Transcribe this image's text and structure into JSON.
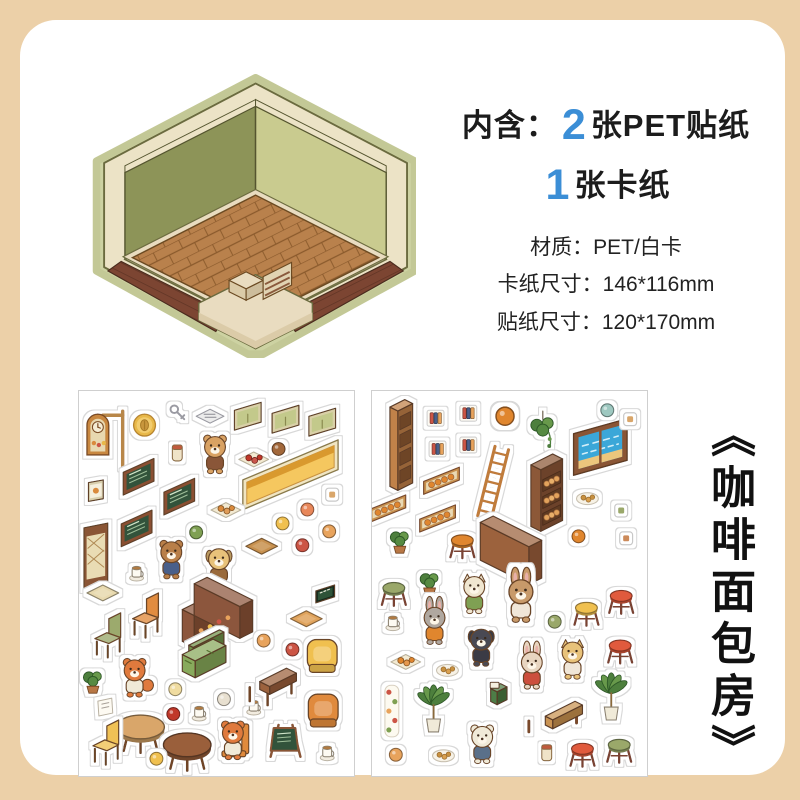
{
  "page": {
    "background": "#ecd0a8",
    "card_background": "#ffffff"
  },
  "header": {
    "prefix": "内含：",
    "count_stickers": "2",
    "stickers_label": "张PET贴纸",
    "count_card": "1",
    "card_label": "张卡纸",
    "accent_color": "#3b8ed6"
  },
  "specs": {
    "material": "材质：PET/白卡",
    "card_size": "卡纸尺寸：146*116mm",
    "sticker_size": "贴纸尺寸：120*170mm"
  },
  "product_title": "《咖啡面包房》",
  "room_preview": {
    "wall_left_color": "#8d9458",
    "wall_right_color": "#c9cb8f",
    "floor_color": "#b9814c",
    "deck_color": "#7c4532",
    "platform_color": "#e9dcc0",
    "trim_color": "#ece3c6"
  },
  "sheets": [
    {
      "name": "sticker-sheet-1",
      "theme": "coffee-shop",
      "stickers": [
        {
          "t": "clocksign",
          "n": "hanging-clock-sign",
          "x": 30,
          "y": 50
        },
        {
          "t": "coin",
          "n": "coffee-bean-coin",
          "x": 66,
          "y": 34
        },
        {
          "t": "keys",
          "n": "keys",
          "x": 99,
          "y": 22
        },
        {
          "t": "news",
          "n": "newspaper",
          "x": 132,
          "y": 26
        },
        {
          "t": "window",
          "n": "green-window",
          "x": 170,
          "y": 25
        },
        {
          "t": "window",
          "n": "green-window",
          "x": 208,
          "y": 28
        },
        {
          "t": "window",
          "n": "green-window",
          "x": 245,
          "y": 31
        },
        {
          "t": "jar",
          "n": "coffee-jar",
          "x": 99,
          "y": 62
        },
        {
          "t": "char",
          "n": "bear-barista",
          "x": 137,
          "y": 64,
          "face": "#d9a264",
          "shirt": "#8a5638",
          "ear": "round"
        },
        {
          "t": "tray",
          "n": "plate-of-food",
          "x": 176,
          "y": 69,
          "c": "#c0392b"
        },
        {
          "t": "mini",
          "n": "acorn",
          "x": 201,
          "y": 58,
          "c": "#a2683a"
        },
        {
          "t": "shelfY",
          "n": "yellow-wall-shelf",
          "x": 213,
          "y": 84
        },
        {
          "t": "poster",
          "n": "small-poster",
          "x": 17,
          "y": 100
        },
        {
          "t": "board",
          "n": "menu-chalkboard",
          "x": 60,
          "y": 86
        },
        {
          "t": "board",
          "n": "menu-chalkboard",
          "x": 101,
          "y": 106
        },
        {
          "t": "board",
          "n": "menu-chalkboard",
          "x": 58,
          "y": 138
        },
        {
          "t": "tray",
          "n": "bread-basket",
          "x": 148,
          "y": 120,
          "c": "#d98a3c"
        },
        {
          "t": "mini",
          "n": "salad-plate",
          "x": 118,
          "y": 142,
          "c": "#7fa052"
        },
        {
          "t": "frame",
          "n": "small-frame",
          "x": 255,
          "y": 104,
          "c": "#d9a66a"
        },
        {
          "t": "mini",
          "n": "macaron",
          "x": 230,
          "y": 119,
          "c": "#e8875a"
        },
        {
          "t": "mini",
          "n": "bread-bun",
          "x": 205,
          "y": 133,
          "c": "#f0c050"
        },
        {
          "t": "mini",
          "n": "pudding",
          "x": 252,
          "y": 141,
          "c": "#e8a35c"
        },
        {
          "t": "mini",
          "n": "cake-slice",
          "x": 225,
          "y": 155,
          "c": "#cc5544"
        },
        {
          "t": "door",
          "n": "lattice-door",
          "x": 17,
          "y": 166
        },
        {
          "t": "char",
          "n": "teddy-bear-plush",
          "x": 93,
          "y": 170,
          "face": "#b97f4a",
          "shirt": "#4a5f8a",
          "ear": "round"
        },
        {
          "t": "char",
          "n": "puppy-with-book",
          "x": 141,
          "y": 177,
          "face": "#e8c27a",
          "shirt": "#9a6a3a",
          "ear": "flop"
        },
        {
          "t": "cup",
          "n": "paper-cup",
          "x": 58,
          "y": 183
        },
        {
          "t": "flat",
          "n": "cutting-board",
          "x": 184,
          "y": 156,
          "c": "#c8914f"
        },
        {
          "t": "flat",
          "n": "floor-mat",
          "x": 24,
          "y": 203,
          "c": "#e8d9ae"
        },
        {
          "t": "lcounter",
          "n": "coffee-counter",
          "x": 162,
          "y": 218
        },
        {
          "t": "sign",
          "n": "coffee-sign",
          "x": 248,
          "y": 204
        },
        {
          "t": "flat",
          "n": "floor-mat",
          "x": 229,
          "y": 229,
          "c": "#e0a35c"
        },
        {
          "t": "chair",
          "n": "orange-chair",
          "x": 66,
          "y": 226,
          "c": "#e08a3c"
        },
        {
          "t": "chair",
          "n": "green-chair",
          "x": 28,
          "y": 246,
          "c": "#9aa86a"
        },
        {
          "t": "char",
          "n": "fox-running",
          "x": 56,
          "y": 289,
          "face": "#e07a3c",
          "shirt": "#f0ead8",
          "ear": "round",
          "tail": 1
        },
        {
          "t": "sofa",
          "n": "green-sofa",
          "x": 117,
          "y": 269
        },
        {
          "t": "mini",
          "n": "cupcake",
          "x": 186,
          "y": 251,
          "c": "#e8a35c"
        },
        {
          "t": "mini",
          "n": "cupcake",
          "x": 215,
          "y": 260,
          "c": "#cc5544"
        },
        {
          "t": "armchair",
          "n": "yellow-armchair",
          "x": 245,
          "y": 266,
          "c": "#f0c050"
        },
        {
          "t": "plant",
          "n": "small-plant",
          "x": 14,
          "y": 291
        },
        {
          "t": "paper",
          "n": "note-paper",
          "x": 26,
          "y": 318
        },
        {
          "t": "rtable",
          "n": "round-table",
          "x": 62,
          "y": 338,
          "c": "#d9a66a"
        },
        {
          "t": "mini",
          "n": "cream-puff",
          "x": 97,
          "y": 300,
          "c": "#f0dca0"
        },
        {
          "t": "mini",
          "n": "jam",
          "x": 95,
          "y": 325,
          "c": "#c0392b"
        },
        {
          "t": "cup",
          "n": "coffee-cup",
          "x": 121,
          "y": 324
        },
        {
          "t": "mini",
          "n": "plate",
          "x": 146,
          "y": 310,
          "c": "#e8e0d0"
        },
        {
          "t": "cup",
          "n": "tea-cup",
          "x": 176,
          "y": 318
        },
        {
          "t": "table",
          "n": "wooden-table",
          "x": 192,
          "y": 292,
          "c": "#9a5f3a"
        },
        {
          "t": "armchair",
          "n": "orange-armchair",
          "x": 246,
          "y": 321,
          "c": "#e08a3c"
        },
        {
          "t": "chair",
          "n": "yellow-chair",
          "x": 26,
          "y": 354,
          "c": "#f0c050"
        },
        {
          "t": "rtable",
          "n": "round-table-dark",
          "x": 109,
          "y": 356,
          "c": "#9a5f3a"
        },
        {
          "t": "char",
          "n": "fox-on-chair",
          "x": 155,
          "y": 352,
          "face": "#e07a3c",
          "shirt": "#f0ead8",
          "ear": "round",
          "chair": 1
        },
        {
          "t": "aframe",
          "n": "menu-stand",
          "x": 206,
          "y": 352
        },
        {
          "t": "cup",
          "n": "coffee-cup",
          "x": 250,
          "y": 364
        },
        {
          "t": "mini",
          "n": "cheese",
          "x": 78,
          "y": 370,
          "c": "#f0c050"
        }
      ]
    },
    {
      "name": "sticker-sheet-2",
      "theme": "bakery",
      "stickers": [
        {
          "t": "bookshelf",
          "n": "tall-shelf",
          "x": 26,
          "y": 54
        },
        {
          "t": "book",
          "n": "book-sticker",
          "x": 64,
          "y": 27
        },
        {
          "t": "book",
          "n": "book-sticker",
          "x": 97,
          "y": 22
        },
        {
          "t": "mini",
          "n": "round-bread",
          "x": 134,
          "y": 25,
          "c": "#e0862f",
          "s": 1.4
        },
        {
          "t": "hangplant",
          "n": "hanging-plant",
          "x": 172,
          "y": 38
        },
        {
          "t": "beachwin",
          "n": "beach-window",
          "x": 230,
          "y": 56
        },
        {
          "t": "mini",
          "n": "oval-mirror",
          "x": 237,
          "y": 19,
          "c": "#9ec8c0"
        },
        {
          "t": "frame",
          "n": "small-frame",
          "x": 260,
          "y": 28,
          "c": "#d9a66a"
        },
        {
          "t": "book",
          "n": "book-sticker",
          "x": 66,
          "y": 58
        },
        {
          "t": "book",
          "n": "book-sticker",
          "x": 97,
          "y": 54
        },
        {
          "t": "ladder",
          "n": "wooden-ladder",
          "x": 122,
          "y": 92
        },
        {
          "t": "breadcase",
          "n": "bread-display-case",
          "x": 170,
          "y": 102
        },
        {
          "t": "breadshelf",
          "n": "bread-wall-shelf",
          "x": 70,
          "y": 90
        },
        {
          "t": "breadshelf",
          "n": "bread-wall-shelf",
          "x": 16,
          "y": 118
        },
        {
          "t": "breadshelf",
          "n": "bread-wall-shelf",
          "x": 66,
          "y": 128
        },
        {
          "t": "cookieplate",
          "n": "cookie-plate",
          "x": 217,
          "y": 108
        },
        {
          "t": "frame",
          "n": "small-frame",
          "x": 251,
          "y": 120,
          "c": "#9aa86a"
        },
        {
          "t": "plant",
          "n": "small-plant",
          "x": 28,
          "y": 150
        },
        {
          "t": "stool",
          "n": "stool-orange",
          "x": 91,
          "y": 150,
          "c": "#e0862f"
        },
        {
          "t": "counter2",
          "n": "long-counter",
          "x": 158,
          "y": 160
        },
        {
          "t": "mini",
          "n": "bread-bun",
          "x": 208,
          "y": 146,
          "c": "#e0862f"
        },
        {
          "t": "frame",
          "n": "small-frame",
          "x": 256,
          "y": 148,
          "c": "#cc8a5a"
        },
        {
          "t": "stool",
          "n": "stool-green",
          "x": 22,
          "y": 198,
          "c": "#9aa86a"
        },
        {
          "t": "plant",
          "n": "plant-ball",
          "x": 58,
          "y": 192
        },
        {
          "t": "char",
          "n": "cat-with-bread",
          "x": 103,
          "y": 205,
          "face": "#f0e6d0",
          "shirt": "#7fa052",
          "ear": "point"
        },
        {
          "t": "char",
          "n": "tall-rabbit",
          "x": 150,
          "y": 211,
          "face": "#c89a6a",
          "shirt": "#f0e6d8",
          "ear": "long",
          "s": 1.15
        },
        {
          "t": "cup",
          "n": "coffee-cup",
          "x": 21,
          "y": 233
        },
        {
          "t": "char",
          "n": "gray-bunny",
          "x": 63,
          "y": 236,
          "face": "#b0a8a0",
          "shirt": "#e0862f",
          "ear": "long"
        },
        {
          "t": "mini",
          "n": "drink-cup",
          "x": 184,
          "y": 232,
          "c": "#9aa86a"
        },
        {
          "t": "stool",
          "n": "stool-yellow",
          "x": 216,
          "y": 218,
          "c": "#f0c050"
        },
        {
          "t": "stool",
          "n": "stool-red",
          "x": 251,
          "y": 206,
          "c": "#e05a3c"
        },
        {
          "t": "char",
          "n": "black-dog",
          "x": 110,
          "y": 258,
          "face": "#4a4a52",
          "shirt": "#3a3a45",
          "ear": "flop"
        },
        {
          "t": "stool",
          "n": "stool-red",
          "x": 250,
          "y": 256,
          "c": "#e05a3c"
        },
        {
          "t": "tray",
          "n": "bread-tray",
          "x": 34,
          "y": 273,
          "c": "#e0862f"
        },
        {
          "t": "cookieplate",
          "n": "croissant-plate",
          "x": 76,
          "y": 281
        },
        {
          "t": "char",
          "n": "bunny-red-dress",
          "x": 161,
          "y": 281,
          "face": "#e8d5c0",
          "shirt": "#cc4f3d",
          "ear": "long"
        },
        {
          "t": "char",
          "n": "yellow-cat",
          "x": 202,
          "y": 271,
          "face": "#e8c27a",
          "shirt": "#f0e6d8",
          "ear": "point"
        },
        {
          "t": "register",
          "n": "cash-register",
          "x": 126,
          "y": 305
        },
        {
          "t": "flowerstrip",
          "n": "flower-strip",
          "x": 20,
          "y": 322
        },
        {
          "t": "palm",
          "n": "palm-plant",
          "x": 62,
          "y": 322
        },
        {
          "t": "bench",
          "n": "wooden-bench",
          "x": 182,
          "y": 326
        },
        {
          "t": "palm",
          "n": "palm-plant",
          "x": 241,
          "y": 310
        },
        {
          "t": "char",
          "n": "bear-eating",
          "x": 111,
          "y": 356,
          "face": "#f0ead8",
          "shirt": "#5a6f8a",
          "ear": "round"
        },
        {
          "t": "mini",
          "n": "snack",
          "x": 24,
          "y": 366,
          "c": "#e8a35c"
        },
        {
          "t": "cookieplate",
          "n": "cookie-plate",
          "x": 72,
          "y": 367
        },
        {
          "t": "jar",
          "n": "milk-bottle",
          "x": 176,
          "y": 364
        },
        {
          "t": "stool",
          "n": "stool-red",
          "x": 212,
          "y": 360,
          "c": "#e05a3c"
        },
        {
          "t": "stool",
          "n": "stool-green",
          "x": 249,
          "y": 356,
          "c": "#9aa86a"
        }
      ]
    }
  ]
}
